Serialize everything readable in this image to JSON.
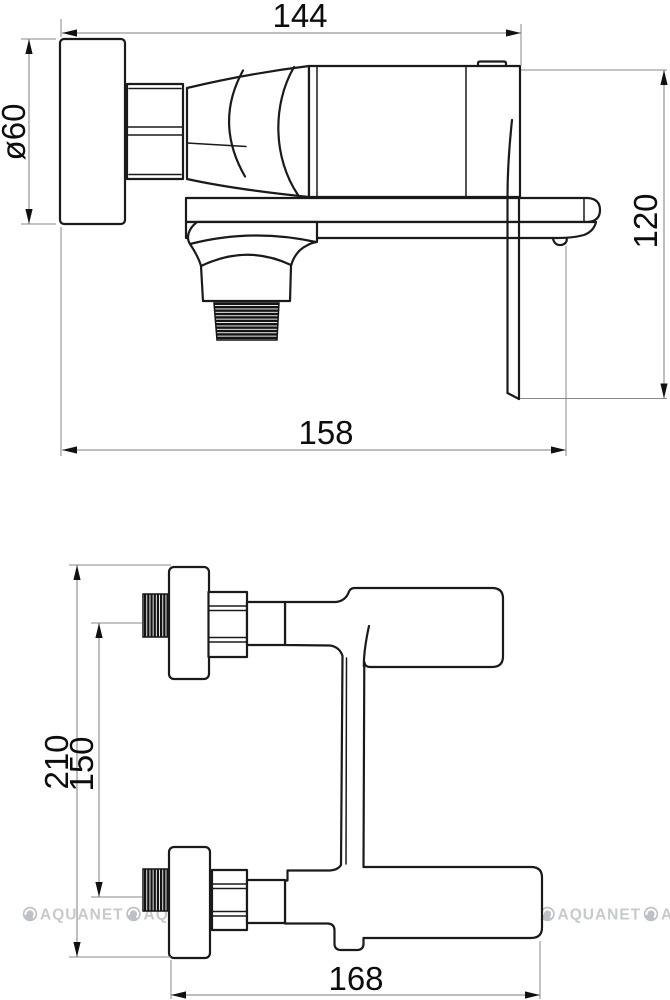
{
  "drawing": {
    "type": "technical-dimension-drawing",
    "subject": "wall-mounted waterfall bath mixer faucet, side view (top) and front view (bottom)"
  },
  "side_view": {
    "label_width": "144",
    "label_diameter": "ø60",
    "label_height": "120",
    "label_depth": "158"
  },
  "front_view": {
    "label_total_height": "210",
    "label_port_spacing": "150",
    "label_width": "168"
  },
  "watermark": {
    "text": "AQUANET",
    "icon": "aquanet-logo-circle-icon",
    "count": 7,
    "color": "#c7cacd"
  },
  "colors": {
    "background": "#ffffff",
    "line": "#1a1a1a",
    "dimension_line": "#7d7d7d",
    "dimension_text": "#0d0d0d",
    "thread_fill": "#141414"
  }
}
